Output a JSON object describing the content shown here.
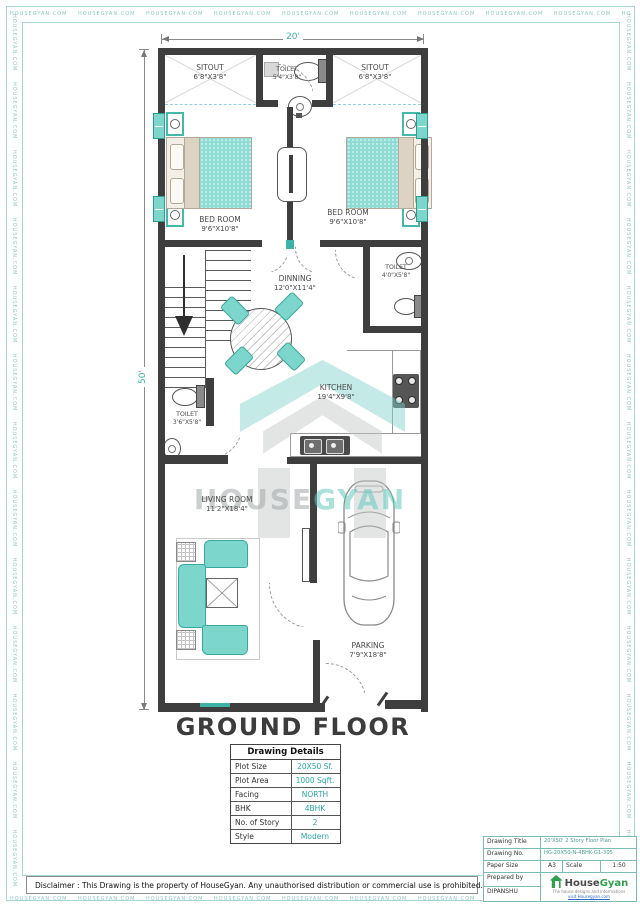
{
  "page": {
    "border_watermark": "HOUSEGYAN.COM",
    "disclaimer": "Disclaimer : This Drawing is the property of HouseGyan. Any unauthorised distribution or commercial use is prohibited."
  },
  "plan": {
    "floor_title": "GROUND FLOOR",
    "dims": {
      "width": "20'",
      "height": "50'"
    },
    "watermark": {
      "house": "HOUSE",
      "gyan": "GYAN"
    },
    "rooms": {
      "sitout_left": {
        "name": "SITOUT",
        "size": "6'8\"X3'8\""
      },
      "toilet_top": {
        "name": "TOILET",
        "size": "5'4\"X3'8\""
      },
      "sitout_right": {
        "name": "SITOUT",
        "size": "6'8\"X3'8\""
      },
      "bed_left": {
        "name": "BED ROOM",
        "size": "9'6\"X10'8\""
      },
      "bed_right": {
        "name": "BED ROOM",
        "size": "9'6\"X10'8\""
      },
      "dinning": {
        "name": "DINNING",
        "size": "12'0\"X11'4\""
      },
      "toilet_mid": {
        "name": "TOILET",
        "size": "4'0\"X5'8\""
      },
      "toilet_lower": {
        "name": "TOILET",
        "size": "3'6\"X5'8\""
      },
      "kitchen": {
        "name": "KITCHEN",
        "size": "19'4\"X9'8\""
      },
      "living": {
        "name": "LIVING ROOM",
        "size": "11'2\"X18'4\""
      },
      "parking": {
        "name": "PARKING",
        "size": "7'9\"X18'8\""
      }
    }
  },
  "details_table": {
    "title": "Drawing Details",
    "rows": [
      {
        "label": "Plot Size",
        "value": "20X50 Sf."
      },
      {
        "label": "Plot Area",
        "value": "1000 Sqft."
      },
      {
        "label": "Facing",
        "value": "NORTH"
      },
      {
        "label": "BHK",
        "value": "4BHK"
      },
      {
        "label": "No. of Story",
        "value": "2"
      },
      {
        "label": "Style",
        "value": "Modern"
      }
    ]
  },
  "title_block": {
    "drawing_title_label": "Drawing Title",
    "drawing_title": "20'X50' 2 Story Floor Plan",
    "drawing_no_label": "Drawing No.",
    "drawing_no": "HG-20X50-N-4BHK-G1-305",
    "paper_size_label": "Paper Size",
    "paper_size": "A3",
    "scale_label": "Scale",
    "scale": "1:50",
    "prepared_by_label": "Prepared by",
    "prepared_by": "DIPANSHU",
    "brand_house": "House",
    "brand_gyan": "Gyan",
    "brand_tagline": "The house designs and informations",
    "brand_link": "visit Housegyan.com"
  },
  "colors": {
    "wall": "#3e3e3e",
    "furniture_teal": "#7dd6cc",
    "accent_teal": "#3bb3a8",
    "value_teal": "#29a99d",
    "brand_green": "#2fa14b",
    "watermark_teal": "#8cc9c2"
  }
}
